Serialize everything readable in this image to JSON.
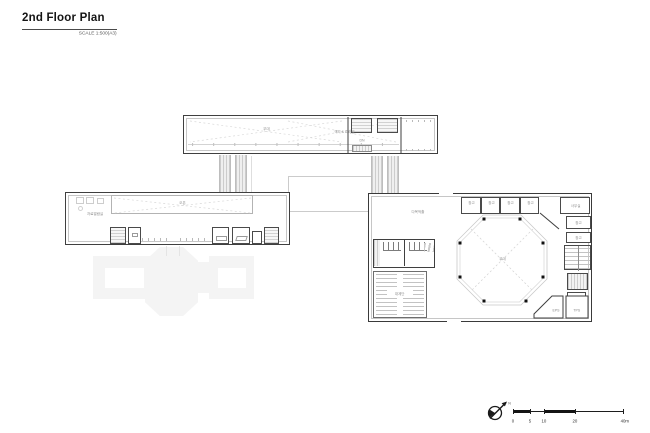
{
  "header": {
    "title": "2nd Floor Plan",
    "scale_note": "SCALE 1:500(A3)"
  },
  "upper_building": {
    "void_label": "무대",
    "right_label": "객석 & 리허설",
    "dn_label": "DN"
  },
  "left_building": {
    "name_label": "자료열람실",
    "void_label": "오픈"
  },
  "right_building": {
    "hall_label": "다목적홀",
    "octagon_label": "무대",
    "stair_label": "대계단",
    "cells": [
      "창고",
      "창고",
      "창고",
      "창고"
    ],
    "corner_room": "사무실",
    "side_rooms": [
      "창고",
      "창고"
    ],
    "shaft_left": "EPS",
    "shaft_right": "TPS"
  },
  "compass": {
    "north": "N"
  },
  "scalebar": {
    "labels": [
      "0",
      "5",
      "10",
      "20",
      "40m"
    ]
  },
  "colors": {
    "wall": "#3f3f3f",
    "hatch": "#cdcdcd",
    "ghost": "#f4f4f4",
    "ink": "#141414"
  }
}
